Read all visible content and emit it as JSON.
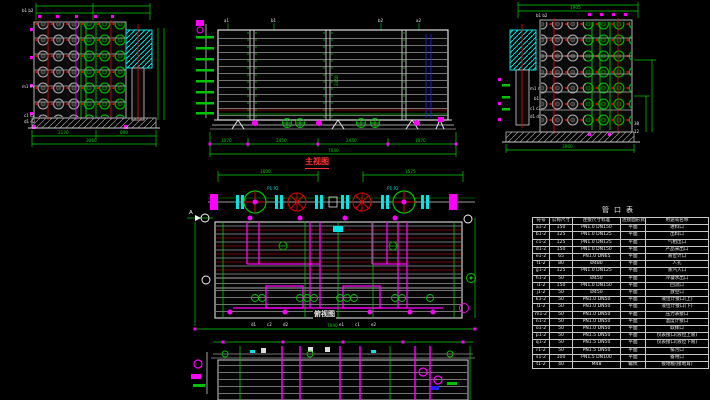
{
  "canvas": {
    "width": 710,
    "height": 400,
    "background": "#000000"
  },
  "colors": {
    "dimension_green": "#00d400",
    "pipe_magenta": "#ff00ff",
    "fitting_cyan": "#00e5e5",
    "centerline_red": "#e00000",
    "shell_dark_red": "#7a0000",
    "steel_gray": "#9a9a9a",
    "outline_white": "#d8d8d8",
    "accent_blue": "#2020ff"
  },
  "left_view": {
    "tag_top": "b1 b2",
    "tag_mid": "m1 m2",
    "tag_low1": "c1 c2",
    "tag_low2": "d1 d2",
    "dim_a": "2170",
    "dim_b": "890",
    "dim_total": "3060"
  },
  "front_view": {
    "title": "主视图",
    "top_tags": [
      "a1",
      "b1",
      "b2",
      "a2"
    ],
    "inner_dim": "2450",
    "dims": [
      "1070",
      "2450",
      "2450",
      "1070"
    ],
    "dim_total": "7040"
  },
  "right_view": {
    "tag_top": "b1 b2",
    "tag_m": "m1 m2",
    "tag_b": "b1",
    "tag_c": "c1 c2",
    "tag_d": "d1 d2",
    "dim_top": "1905",
    "dim_total": "3060",
    "side_label_a": "38",
    "side_label_b": "12"
  },
  "plan_view": {
    "title": "俯视图",
    "dim_left": "1600",
    "dim_right": "1575",
    "dim_total": "7040",
    "pump_tag_left": "P1 P2",
    "pump_tag_right": "P1 P2",
    "section_label": "A",
    "bottom_tags": [
      "d1",
      "c2",
      "d2",
      "e1",
      "c1",
      "e2"
    ]
  },
  "table": {
    "title": "管口表",
    "headers": [
      "符号",
      "公称尺寸",
      "连接尺寸标准",
      "连接面形式",
      "用途或名称"
    ],
    "rows": [
      {
        "sym": "a1-2",
        "dn": "150",
        "std": "PN1.0 DN150",
        "face": "平面",
        "use": "进料口"
      },
      {
        "sym": "b1-2",
        "dn": "125",
        "std": "PN1.0 DN125",
        "face": "平面",
        "use": "出料口"
      },
      {
        "sym": "c1-2",
        "dn": "125",
        "std": "PN1.0 DN125",
        "face": "平面",
        "use": "气相出口"
      },
      {
        "sym": "d1-2",
        "dn": "150",
        "std": "PN1.0 DN150",
        "face": "平面",
        "use": "产品采出口"
      },
      {
        "sym": "e1-2",
        "dn": "65",
        "std": "PN1.0 DN65",
        "face": "平面",
        "use": "液位计口"
      },
      {
        "sym": "f1-2",
        "dn": "80",
        "std": "Ø480",
        "face": "平面",
        "use": "人孔"
      },
      {
        "sym": "g1-2",
        "dn": "125",
        "std": "PN1.0 DN125",
        "face": "平面",
        "use": "蒸汽入口"
      },
      {
        "sym": "h1-2",
        "dn": "50",
        "std": "Ø450",
        "face": "平面",
        "use": "冷凝水出口"
      },
      {
        "sym": "i1-2",
        "dn": "150",
        "std": "PN1.0 DN150",
        "face": "平面",
        "use": "回流口"
      },
      {
        "sym": "j1-2",
        "dn": "50",
        "std": "Ø450",
        "face": "平面",
        "use": "放空口"
      },
      {
        "sym": "k1-2",
        "dn": "50",
        "std": "PN1.0 DN50",
        "face": "平面",
        "use": "液位计接口(上)"
      },
      {
        "sym": "l1-2",
        "dn": "50",
        "std": "PN1.0 DN50",
        "face": "平面",
        "use": "液位计接口(下)"
      },
      {
        "sym": "m1-2",
        "dn": "50",
        "std": "PN1.0 DN50",
        "face": "平面",
        "use": "压力表接口"
      },
      {
        "sym": "n1-2",
        "dn": "50",
        "std": "PN1.0 DN50",
        "face": "平面",
        "use": "温度计接口"
      },
      {
        "sym": "o1-2",
        "dn": "50",
        "std": "PN1.0 DN50",
        "face": "平面",
        "use": "取样口"
      },
      {
        "sym": "p1-2",
        "dn": "50",
        "std": "PN1.5 DN50",
        "face": "平面",
        "use": "仪表接口(液位上限)"
      },
      {
        "sym": "q1-2",
        "dn": "50",
        "std": "PN1.5 DN50",
        "face": "平面",
        "use": "仪表接口(液位下限)"
      },
      {
        "sym": "r1-2",
        "dn": "50",
        "std": "PN1.5 DN50",
        "face": "平面",
        "use": "排污口"
      },
      {
        "sym": "s1-2",
        "dn": "100",
        "std": "PN1.5 DN100",
        "face": "平面",
        "use": "备用口"
      },
      {
        "sym": "t1-2",
        "dn": "40",
        "std": "M48",
        "face": "螺纹",
        "use": "接地板(接地耳)"
      }
    ]
  }
}
